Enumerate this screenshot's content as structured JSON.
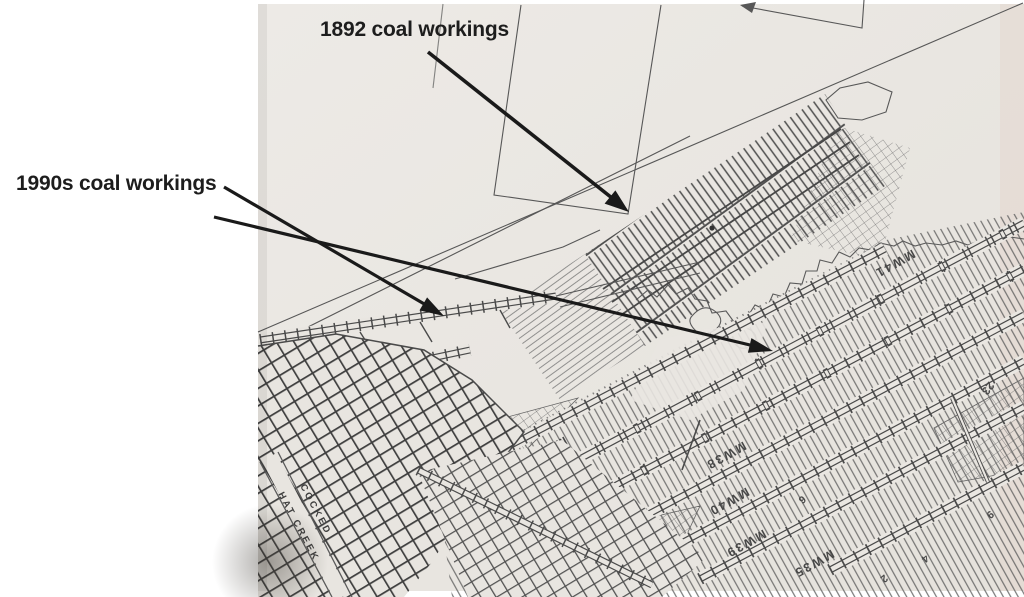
{
  "annotations": {
    "label_1892": "1892 coal workings",
    "label_1990s": "1990s coal workings"
  },
  "map_labels": {
    "creek_upper": "COCKED",
    "creek_lower": "HAT CREEK",
    "mw43": "MW43",
    "mw41": "MW41",
    "mw38": "MW38",
    "mw40": "MW40",
    "mw39": "MW39",
    "mw35": "MW35",
    "n23": "23",
    "d6": "6",
    "d4": "4",
    "d2": "2",
    "d9": "9"
  },
  "colors": {
    "page": "#ffffff",
    "paper": "#e9e6e1",
    "ink": "#4a4a4a",
    "annotation": "#1d1d1d"
  }
}
